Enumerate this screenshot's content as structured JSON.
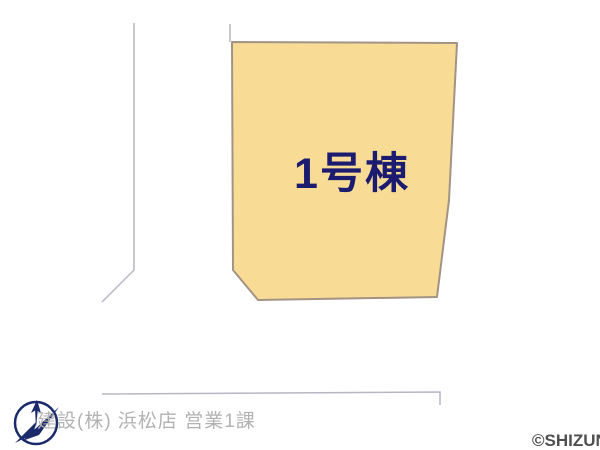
{
  "plan": {
    "parcel": {
      "label": "1号棟",
      "fill_color": "#f8dc96",
      "border_color": "#a39384",
      "label_color": "#1b1b6f"
    },
    "road_line_color": "#b6b6c4"
  },
  "footer": {
    "company_caption": "建設(株) 浜松店 営業1課",
    "caption_color": "#b2b2b2",
    "watermark": "©SHIZUNAV",
    "watermark_color": "#4f4f4f",
    "logo_color": "#1b2a6b"
  }
}
